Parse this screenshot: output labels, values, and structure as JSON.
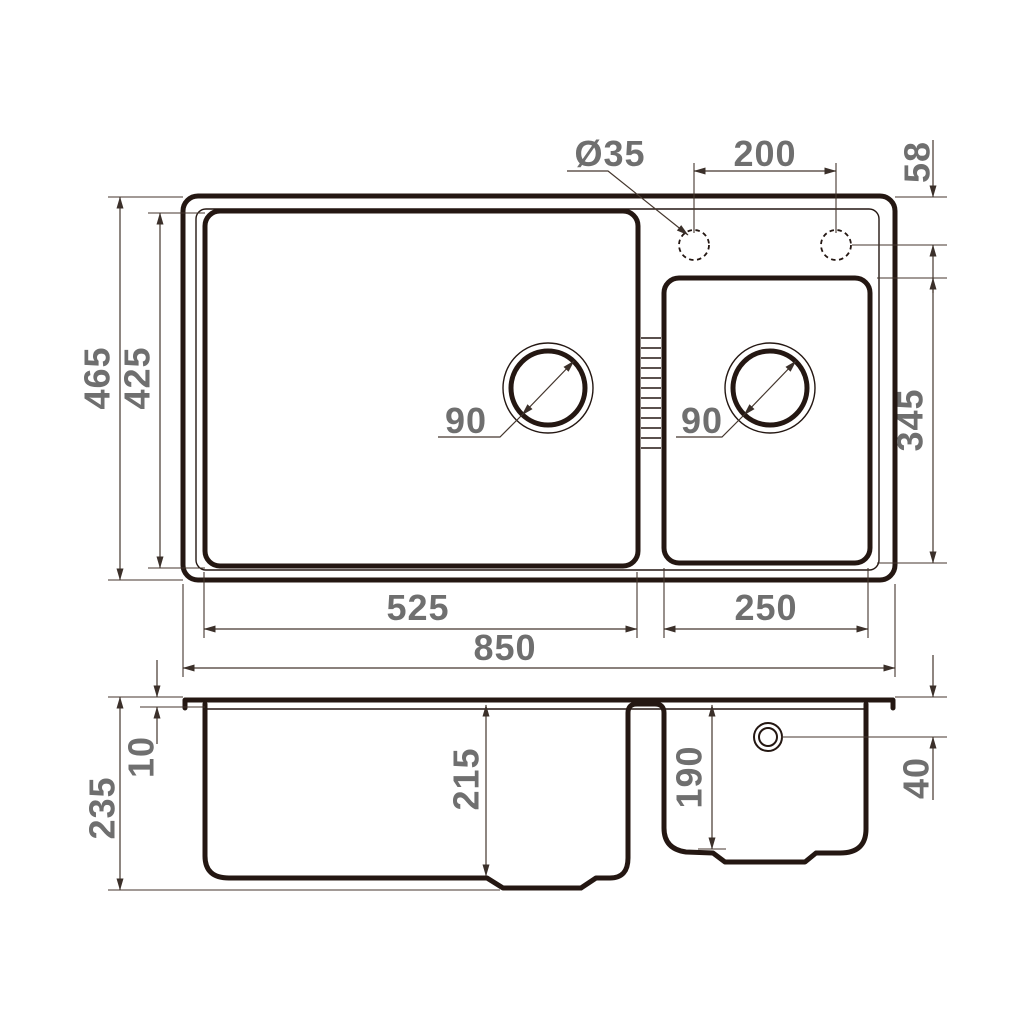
{
  "drawing": {
    "colors": {
      "line": "#241712",
      "dimension_text": "#6f6f6f"
    },
    "top_view": {
      "faucet_hole_diameter": "Ø35",
      "faucet_hole_spacing": "200",
      "faucet_hole_offset_from_edge": "58",
      "overall_depth": "465",
      "main_bowl_depth_plan": "425",
      "main_drain_diameter": "90",
      "small_drain_diameter": "90",
      "small_bowl_depth_plan": "345",
      "main_bowl_width": "525",
      "small_bowl_width": "250",
      "overall_width": "850"
    },
    "section_view": {
      "rim_thickness": "10",
      "overall_height": "235",
      "main_bowl_depth": "215",
      "small_bowl_depth": "190",
      "overflow_offset_from_top": "40"
    }
  }
}
